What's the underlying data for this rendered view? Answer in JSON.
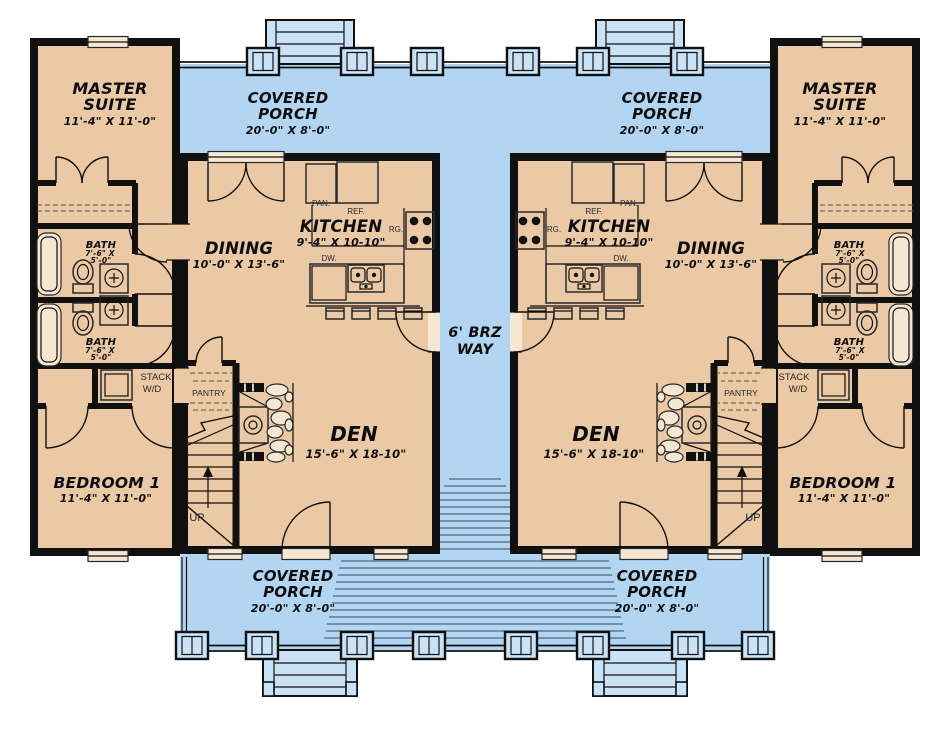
{
  "plan": {
    "rooms": {
      "master_suite": {
        "line1": "MASTER",
        "line2": "SUITE",
        "dims": "11'-4\" X 11'-0\""
      },
      "covered_porch": {
        "line1": "COVERED",
        "line2": "PORCH",
        "dims": "20'-0\" X 8'-0\""
      },
      "dining": {
        "name": "DINING",
        "dims": "10'-0\" X 13'-6\""
      },
      "kitchen": {
        "name": "KITCHEN",
        "dims": "9'-4\" X 10-10\""
      },
      "den": {
        "name": "DEN",
        "dims": "15'-6\" X 18-10\""
      },
      "bedroom1": {
        "name": "BEDROOM 1",
        "dims": "11'-4\" X 11'-0\""
      },
      "bath": {
        "name": "BATH",
        "dims_line1": "7'-6\" X",
        "dims_line2": "5'-0\""
      },
      "breezeway": {
        "line1": "6' BRZ",
        "line2": "WAY"
      },
      "stack_wd": {
        "line1": "STACK",
        "line2": "W/D"
      },
      "pantry": "PANTRY",
      "up": "UP"
    },
    "appliances": {
      "pan": "PAN.",
      "ref": "REF.",
      "rg": "RG.",
      "dw": "DW."
    },
    "colors": {
      "floor": "#ebc9a4",
      "porch": "#b2d6f2",
      "wall": "#101010",
      "deck_line": "#5e7890"
    }
  }
}
